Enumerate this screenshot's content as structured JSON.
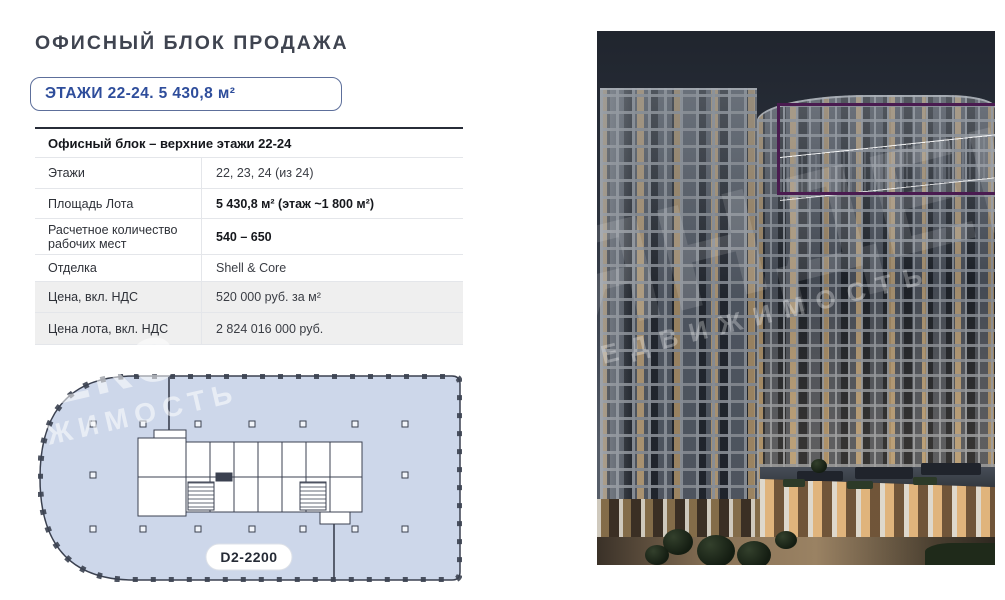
{
  "page": {
    "title": "ОФИСНЫЙ БЛОК ПРОДАЖА",
    "badge": "ЭТАЖИ 22-24. 5 430,8 м²"
  },
  "table": {
    "header": "Офисный блок – верхние этажи 22-24",
    "rows": [
      {
        "label": "Этажи",
        "value": "22, 23, 24 (из 24)"
      },
      {
        "label": "Площадь Лота",
        "value": "5 430,8 м² (этаж ~1 800 м²)"
      },
      {
        "label": "Расчетное количество рабочих мест",
        "value": "540 – 650"
      },
      {
        "label": "Отделка",
        "value": "Shell & Core"
      },
      {
        "label": "Цена, вкл. НДС",
        "value": "520 000 руб. за м²"
      },
      {
        "label": "Цена лота, вкл. НДС",
        "value": "2 824 016 000 руб."
      }
    ]
  },
  "floor_plan": {
    "label": "D2-2200"
  },
  "watermark": {
    "line1": "ЯНДЕКС",
    "line2": "НЕДВИЖИМОСТЬ"
  },
  "colors": {
    "accent_blue": "#2e4d9b",
    "plan_fill": "#cdd7ea",
    "highlight_outline": "#4a1b50",
    "table_shaded_row": "#efefef"
  }
}
